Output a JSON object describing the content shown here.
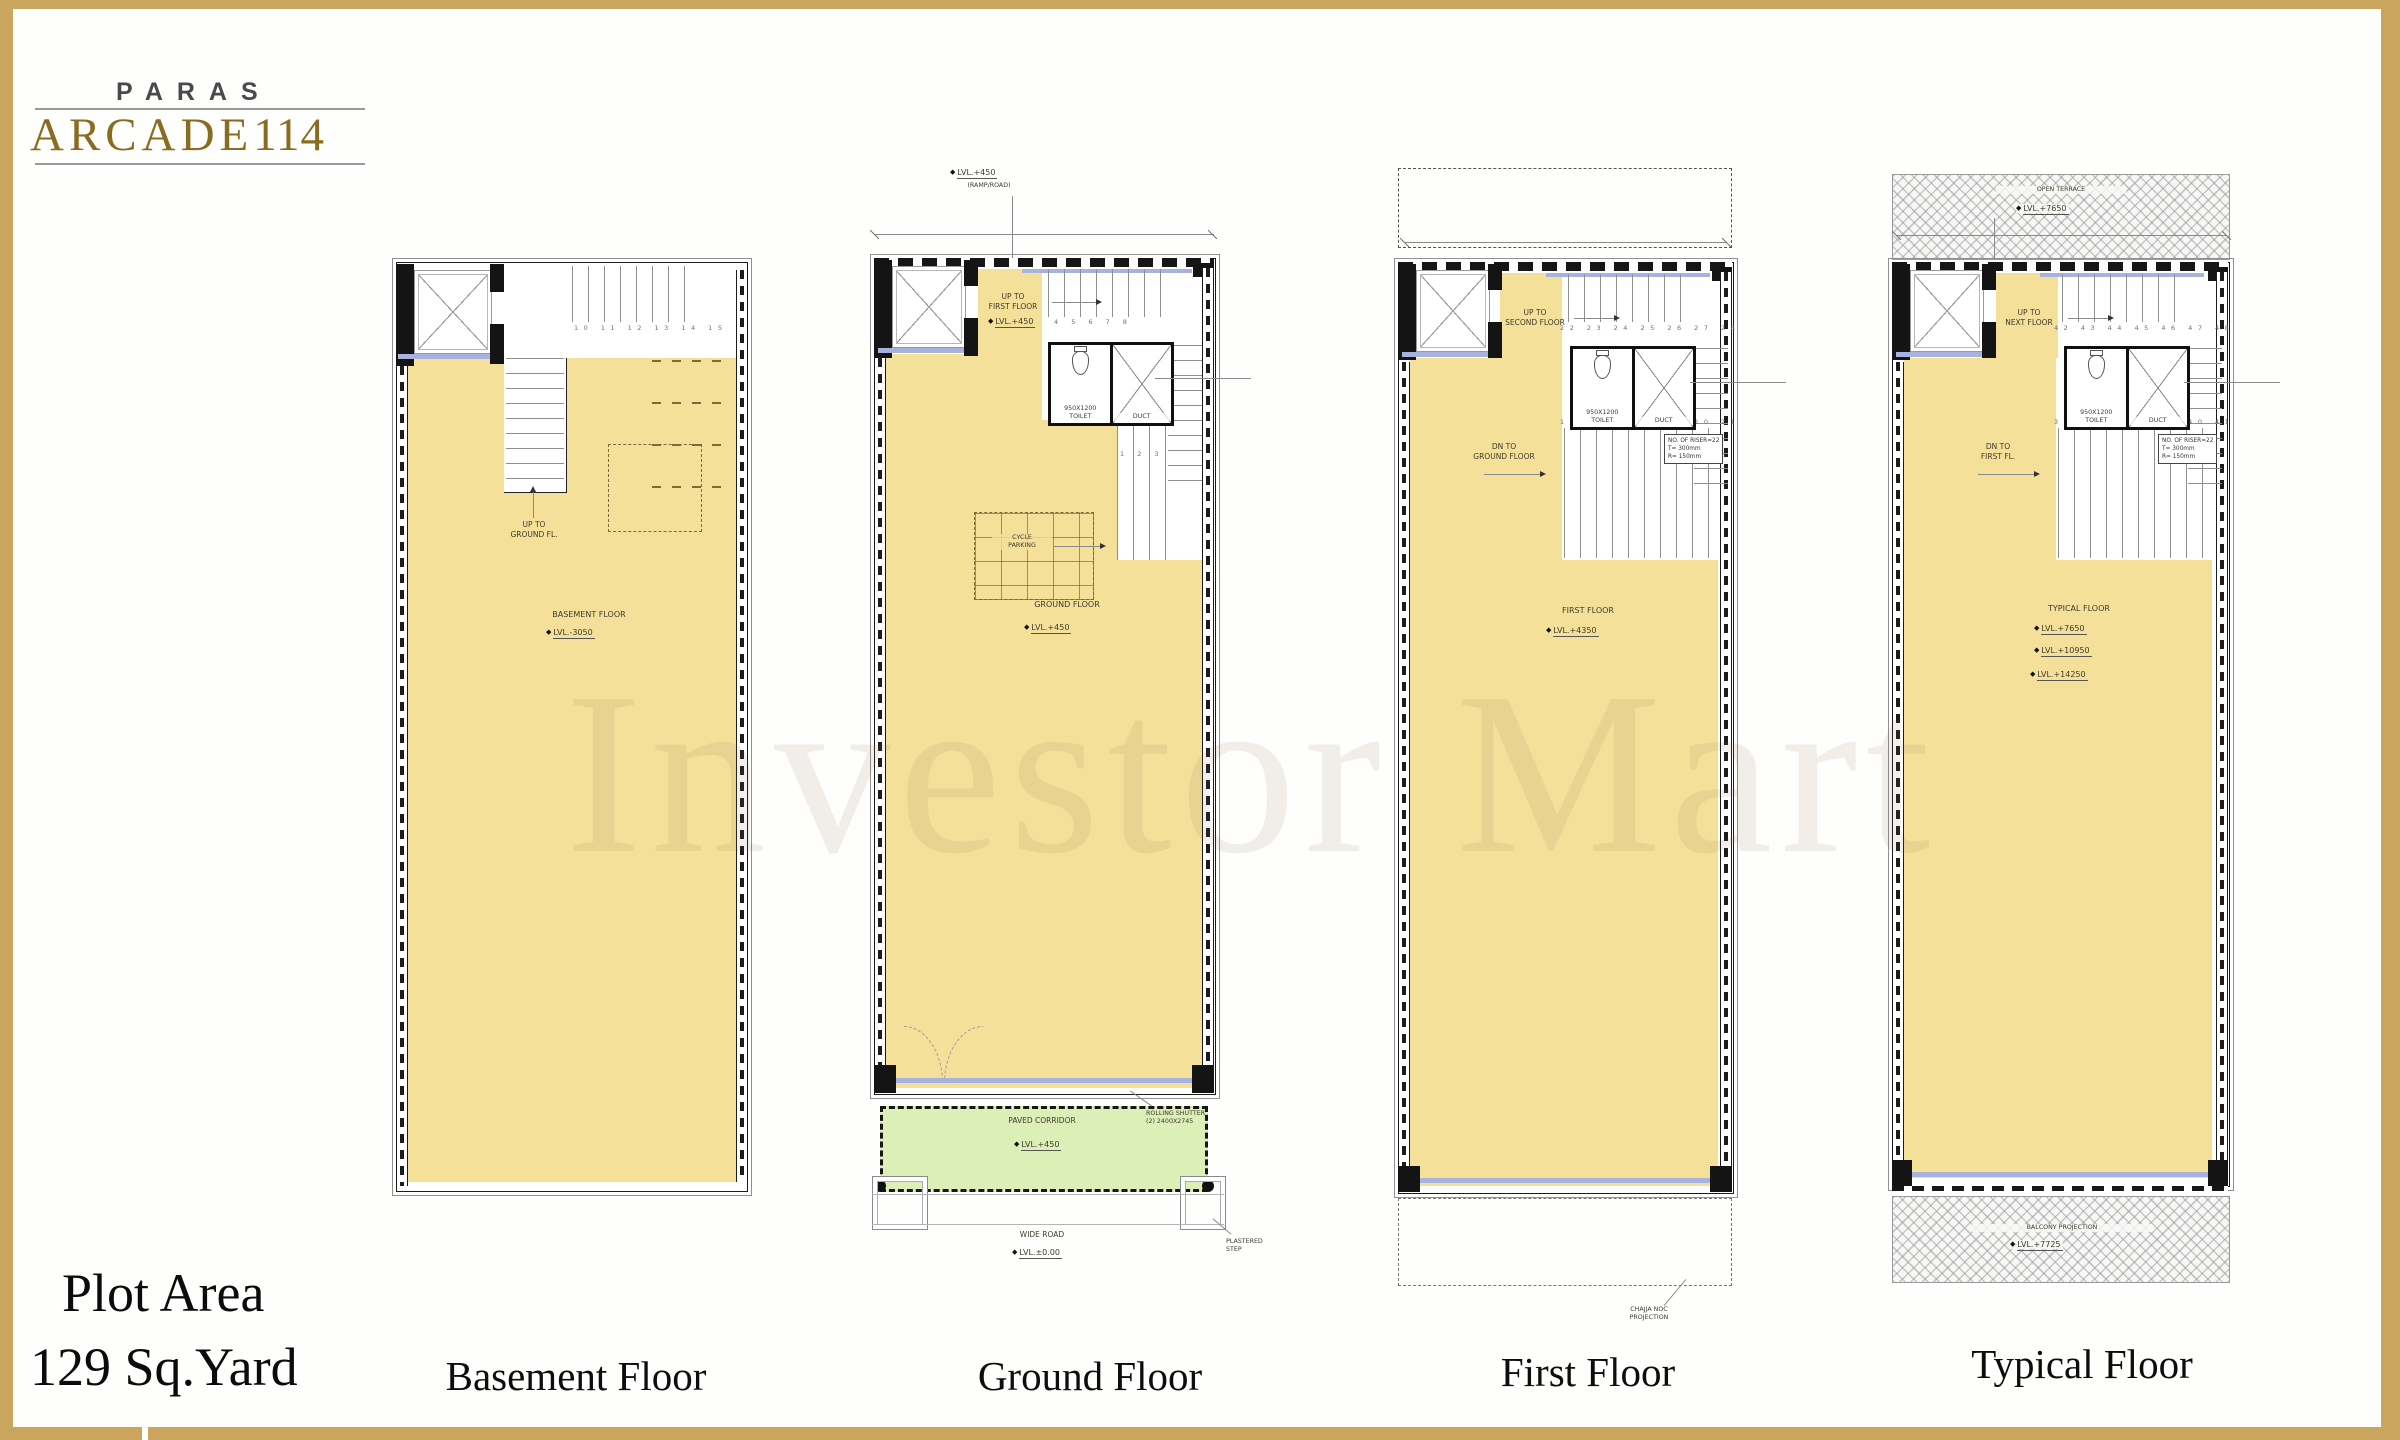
{
  "brand": {
    "top": "PARAS",
    "main": "ARCADE",
    "suffix": "114"
  },
  "watermark": "Investor Mart",
  "plot": {
    "line1": "Plot Area",
    "line2": "129 Sq.Yard"
  },
  "captions": {
    "basement": "Basement Floor",
    "ground": "Ground Floor",
    "first": "First Floor",
    "typical": "Typical Floor"
  },
  "palette": {
    "frame_gold": "#C9A55E",
    "plan_yellow": "#F5E09A",
    "corridor_green": "#DCEFB6",
    "window_blue": "#A8B2DF",
    "wall_black": "#141414"
  },
  "basement": {
    "steps_top": "10 11 12 13 14 15",
    "up1": "UP TO",
    "up2": "GROUND FL.",
    "name": "BASEMENT FLOOR",
    "level": "LVL.-3050"
  },
  "ground": {
    "ramp_lvl": "LVL.+450",
    "ramp_note": "(RAMP/ROAD)",
    "up1": "UP TO",
    "up2": "FIRST FLOOR",
    "entry_lvl": "LVL.+450",
    "steps_top": "4 5 6 7 8",
    "toilet1": "950X1200",
    "toilet2": "TOILET",
    "duct": "DUCT",
    "grid1": "CYCLE",
    "grid2": "PARKING",
    "steps_low": "1 2 3",
    "name": "GROUND FLOOR",
    "level": "LVL.+450",
    "corridor": "PAVED CORRIDOR",
    "corridor_lvl": "LVL.+450",
    "shutter1": "ROLLING SHUTTER",
    "shutter2": "(2) 2400X2745",
    "road": "WIDE ROAD",
    "road_lvl": "LVL.±0.00",
    "kerb1": "PLASTERED",
    "kerb2": "STEP"
  },
  "first": {
    "steps_top": "22 23 24 25 26 27 28",
    "up1": "UP TO",
    "up2": "SECOND FLOOR",
    "toilet1": "950X1200",
    "toilet2": "TOILET",
    "duct": "DUCT",
    "dn1": "DN TO",
    "dn2": "GROUND FLOOR",
    "steps_mid": "15 16 17 18 19 20 21",
    "riser1": "NO. OF RISER=22",
    "riser2": "T= 300mm",
    "riser3": "R= 150mm",
    "name": "FIRST FLOOR",
    "level": "LVL.+4350",
    "noc1": "CHAJJA NOC",
    "noc2": "PROJECTION"
  },
  "typical": {
    "terrace": "OPEN TERRACE",
    "terrace_lvl": "LVL.+7650",
    "steps_top": "42 43 44 45 46 47 48",
    "up1": "UP TO",
    "up2": "NEXT FLOOR",
    "toilet1": "950X1200",
    "toilet2": "TOILET",
    "duct": "DUCT",
    "dn1": "DN TO",
    "dn2": "FIRST FL.",
    "steps_mid": "35 36 37 38 39 40 41",
    "riser1": "NO. OF RISER=22",
    "riser2": "T= 300mm",
    "riser3": "R= 150mm",
    "name": "TYPICAL FLOOR",
    "lvl1": "LVL.+7650",
    "lvl2": "LVL.+10950",
    "lvl3": "LVL.+14250",
    "balcony": "BALCONY PROJECTION",
    "balcony_lvl": "LVL.+7725"
  }
}
